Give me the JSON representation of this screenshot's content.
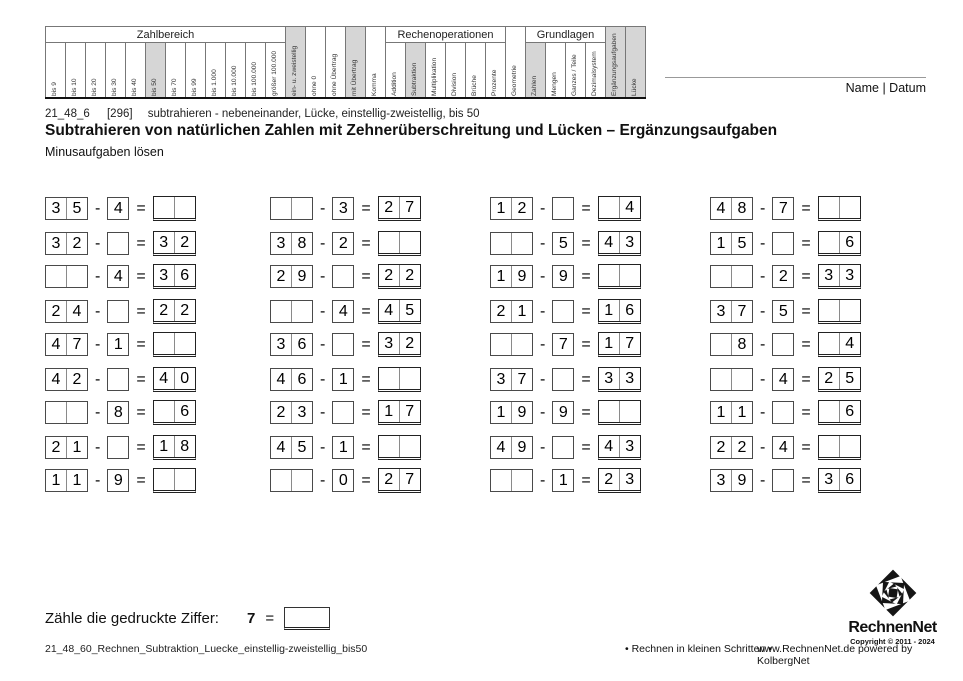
{
  "topic_matrix": {
    "segments": [
      {
        "title": "Zahlbereich",
        "cols": [
          {
            "label": "bis 9"
          },
          {
            "label": "bis 10"
          },
          {
            "label": "bis 20"
          },
          {
            "label": "bis 30"
          },
          {
            "label": "bis 40"
          },
          {
            "label": "bis 50",
            "hl": true
          },
          {
            "label": "bis 70"
          },
          {
            "label": "bis 99"
          },
          {
            "label": "bis 1.000"
          },
          {
            "label": "bis 10.000"
          },
          {
            "label": "bis 100.000"
          },
          {
            "label": "größer 100.000"
          }
        ]
      },
      {
        "title": null,
        "cols": [
          {
            "label": "ein- u. zweistellig",
            "hl": true
          },
          {
            "label": "ohne 0"
          },
          {
            "label": "ohne Übertrag"
          },
          {
            "label": "mit Übertrag",
            "hl": true
          },
          {
            "label": "Komma"
          }
        ]
      },
      {
        "title": "Rechenoperationen",
        "cols": [
          {
            "label": "Addition"
          },
          {
            "label": "Subtraktion",
            "hl": true
          },
          {
            "label": "Multiplikation"
          },
          {
            "label": "Division"
          },
          {
            "label": "Brüche"
          },
          {
            "label": "Prozente"
          }
        ]
      },
      {
        "title": null,
        "cols": [
          {
            "label": "Geometrie"
          }
        ]
      },
      {
        "title": "Grundlagen",
        "cols": [
          {
            "label": "Zahlen",
            "hl": true
          },
          {
            "label": "Mengen"
          },
          {
            "label": "Ganzes / Teile"
          },
          {
            "label": "Dezimalsystem"
          }
        ]
      },
      {
        "title": null,
        "cols": [
          {
            "label": "Ergänzungsaufgaben",
            "hl": true
          },
          {
            "label": "Lücke",
            "hl": true
          }
        ]
      }
    ]
  },
  "header": {
    "name_date_label": "Name | Datum",
    "info_code": "21_48_6",
    "info_ref": "[296]",
    "info_desc": "subtrahieren - nebeneinander, Lücke, einstellig-zweistellig, bis 50",
    "title": "Subtrahieren von natürlichen Zahlen mit Zehnerüberschreitung und Lücken – Ergänzungsaufgaben",
    "subtitle": "Minusaufgaben lösen"
  },
  "problems": {
    "minus": "-",
    "equals": "=",
    "rows": [
      {
        "gap": false,
        "items": [
          {
            "m": [
              "3",
              "5"
            ],
            "s": "4",
            "r": [
              "",
              ""
            ]
          },
          {
            "m": [
              "",
              ""
            ],
            "s": "3",
            "r": [
              "2",
              "7"
            ]
          },
          {
            "m": [
              "1",
              "2"
            ],
            "s": "",
            "r": [
              "",
              "4"
            ]
          },
          {
            "m": [
              "4",
              "8"
            ],
            "s": "7",
            "r": [
              "",
              ""
            ]
          }
        ]
      },
      {
        "gap": true,
        "items": [
          {
            "m": [
              "3",
              "2"
            ],
            "s": "",
            "r": [
              "3",
              "2"
            ]
          },
          {
            "m": [
              "3",
              "8"
            ],
            "s": "2",
            "r": [
              "",
              ""
            ]
          },
          {
            "m": [
              "",
              ""
            ],
            "s": "5",
            "r": [
              "4",
              "3"
            ]
          },
          {
            "m": [
              "1",
              "5"
            ],
            "s": "",
            "r": [
              "",
              "6"
            ]
          }
        ]
      },
      {
        "gap": false,
        "items": [
          {
            "m": [
              "",
              ""
            ],
            "s": "4",
            "r": [
              "3",
              "6"
            ]
          },
          {
            "m": [
              "2",
              "9"
            ],
            "s": "",
            "r": [
              "2",
              "2"
            ]
          },
          {
            "m": [
              "1",
              "9"
            ],
            "s": "9",
            "r": [
              "",
              ""
            ]
          },
          {
            "m": [
              "",
              ""
            ],
            "s": "2",
            "r": [
              "3",
              "3"
            ]
          }
        ]
      },
      {
        "gap": true,
        "items": [
          {
            "m": [
              "2",
              "4"
            ],
            "s": "",
            "r": [
              "2",
              "2"
            ]
          },
          {
            "m": [
              "",
              ""
            ],
            "s": "4",
            "r": [
              "4",
              "5"
            ]
          },
          {
            "m": [
              "2",
              "1"
            ],
            "s": "",
            "r": [
              "1",
              "6"
            ]
          },
          {
            "m": [
              "3",
              "7"
            ],
            "s": "5",
            "r": [
              "",
              ""
            ]
          }
        ]
      },
      {
        "gap": false,
        "items": [
          {
            "m": [
              "4",
              "7"
            ],
            "s": "1",
            "r": [
              "",
              ""
            ]
          },
          {
            "m": [
              "3",
              "6"
            ],
            "s": "",
            "r": [
              "3",
              "2"
            ]
          },
          {
            "m": [
              "",
              ""
            ],
            "s": "7",
            "r": [
              "1",
              "7"
            ]
          },
          {
            "m": [
              "",
              "8"
            ],
            "s": "",
            "r": [
              "",
              "4"
            ]
          }
        ]
      },
      {
        "gap": true,
        "items": [
          {
            "m": [
              "4",
              "2"
            ],
            "s": "",
            "r": [
              "4",
              "0"
            ]
          },
          {
            "m": [
              "4",
              "6"
            ],
            "s": "1",
            "r": [
              "",
              ""
            ]
          },
          {
            "m": [
              "3",
              "7"
            ],
            "s": "",
            "r": [
              "3",
              "3"
            ]
          },
          {
            "m": [
              "",
              ""
            ],
            "s": "4",
            "r": [
              "2",
              "5"
            ]
          }
        ]
      },
      {
        "gap": false,
        "items": [
          {
            "m": [
              "",
              ""
            ],
            "s": "8",
            "r": [
              "",
              "6"
            ]
          },
          {
            "m": [
              "2",
              "3"
            ],
            "s": "",
            "r": [
              "1",
              "7"
            ]
          },
          {
            "m": [
              "1",
              "9"
            ],
            "s": "9",
            "r": [
              "",
              ""
            ]
          },
          {
            "m": [
              "1",
              "1"
            ],
            "s": "",
            "r": [
              "",
              "6"
            ]
          }
        ]
      },
      {
        "gap": true,
        "items": [
          {
            "m": [
              "2",
              "1"
            ],
            "s": "",
            "r": [
              "1",
              "8"
            ]
          },
          {
            "m": [
              "4",
              "5"
            ],
            "s": "1",
            "r": [
              "",
              ""
            ]
          },
          {
            "m": [
              "4",
              "9"
            ],
            "s": "",
            "r": [
              "4",
              "3"
            ]
          },
          {
            "m": [
              "2",
              "2"
            ],
            "s": "4",
            "r": [
              "",
              ""
            ]
          }
        ]
      },
      {
        "gap": false,
        "items": [
          {
            "m": [
              "1",
              "1"
            ],
            "s": "9",
            "r": [
              "",
              ""
            ]
          },
          {
            "m": [
              "",
              ""
            ],
            "s": "0",
            "r": [
              "2",
              "7"
            ]
          },
          {
            "m": [
              "",
              ""
            ],
            "s": "1",
            "r": [
              "2",
              "3"
            ]
          },
          {
            "m": [
              "3",
              "9"
            ],
            "s": "",
            "r": [
              "3",
              "6"
            ]
          }
        ]
      }
    ]
  },
  "task": {
    "label": "Zähle die gedruckte Ziffer:",
    "digit": "7",
    "equals": "="
  },
  "footer": {
    "filename": "21_48_60_Rechnen_Subtraktion_Luecke_einstellig-zweistellig_bis50",
    "slogan": "• Rechnen in kleinen Schritten •",
    "credit": "www.RechnenNet.de powered by KolbergNet",
    "logo_text": "RechnenNet",
    "copyright": "Copyright © 2011 - 2024"
  },
  "colors": {
    "highlight": "#d6d6d6",
    "box_border": "#4a4a4a",
    "result_border": "#222222"
  }
}
